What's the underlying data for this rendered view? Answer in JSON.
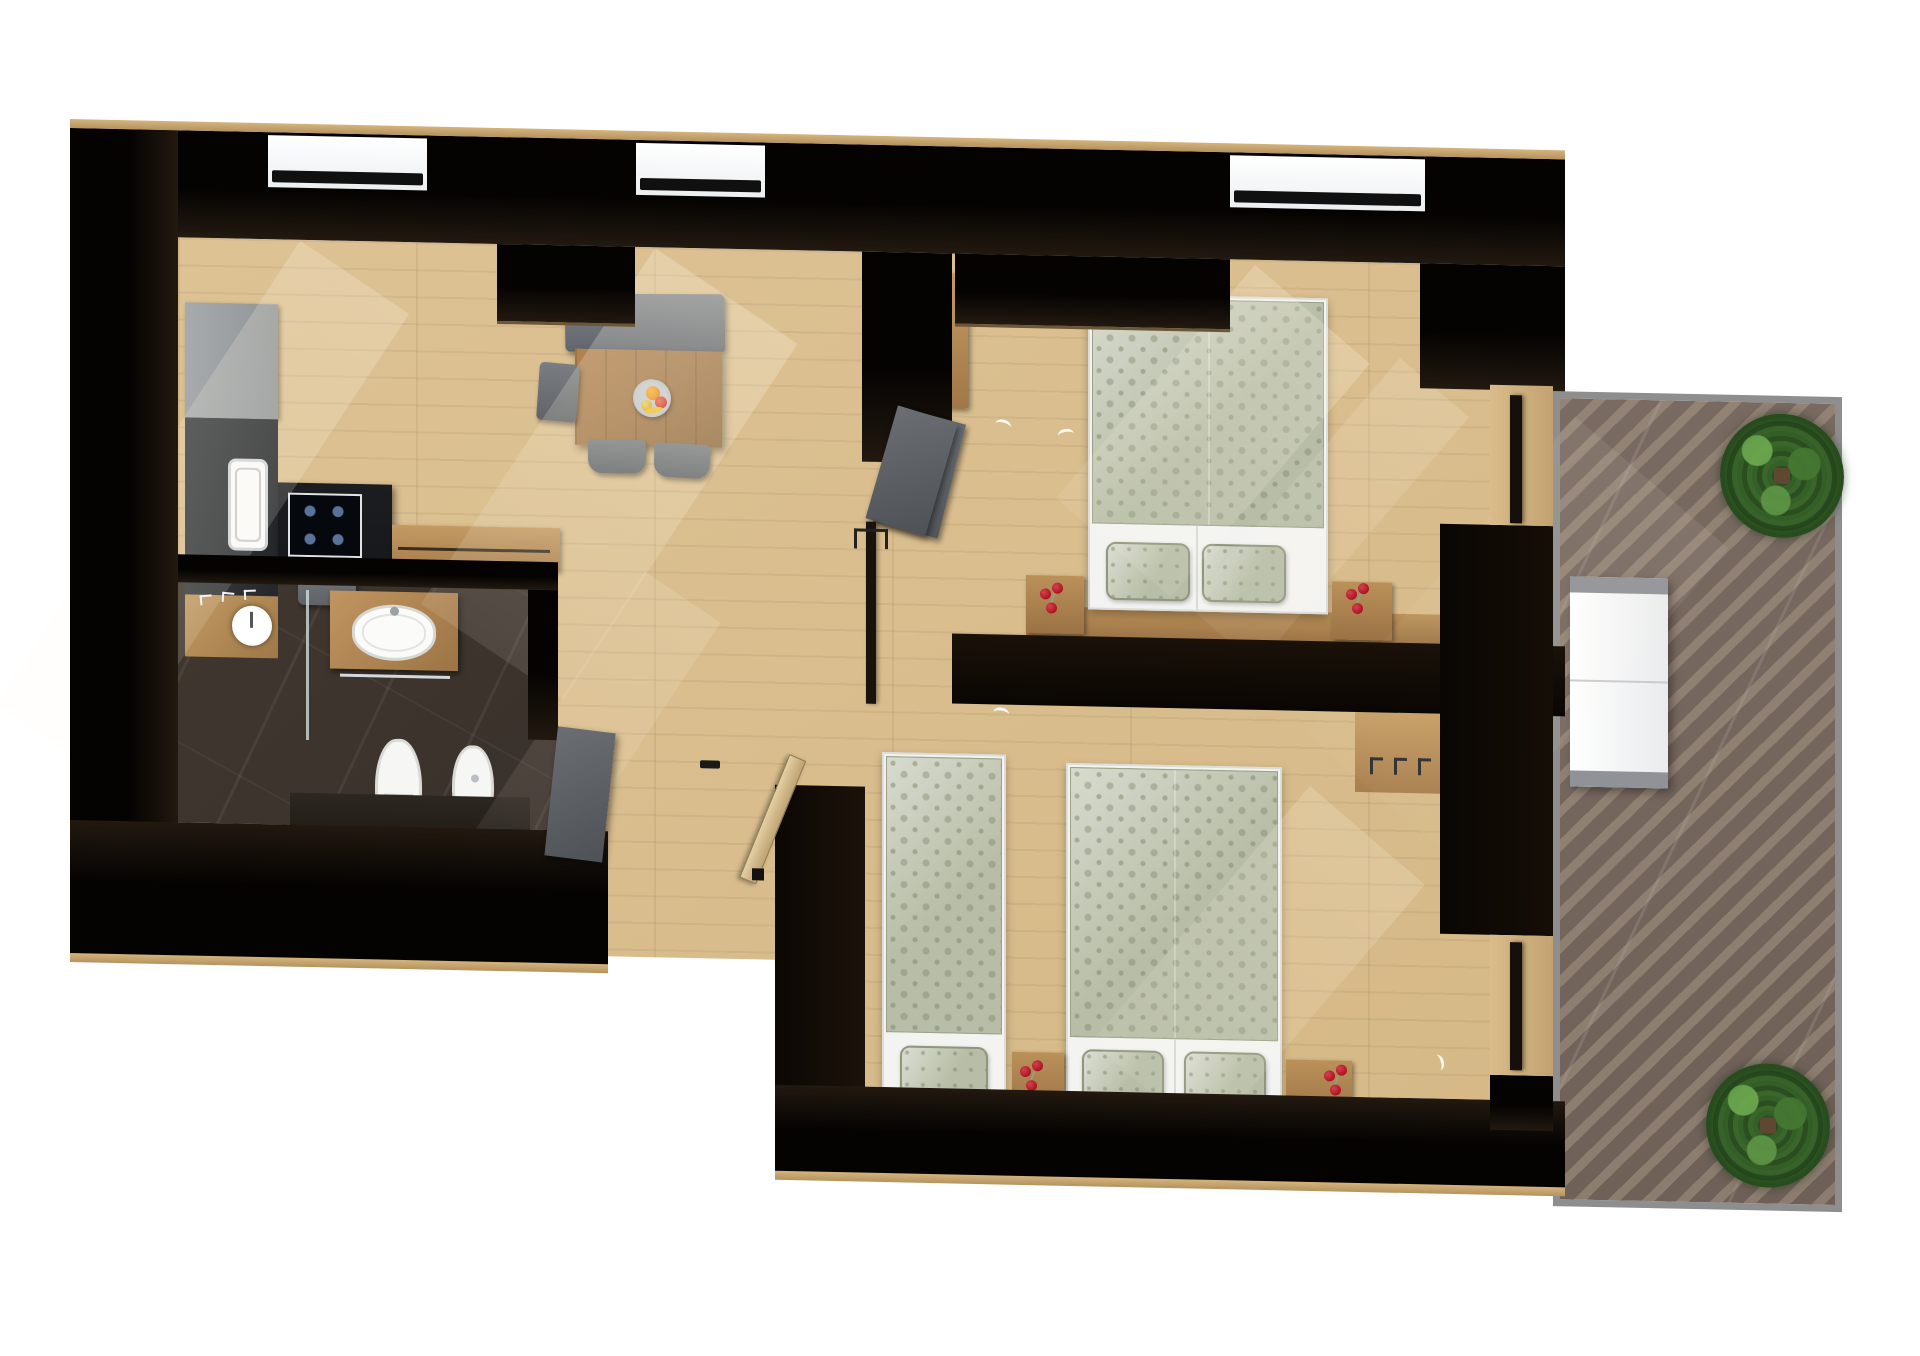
{
  "title": "Top-down 3D rendered apartment floor plan",
  "notes": "Photorealistic bird's-eye render; the image contains no visible text, labels or numbers.",
  "palette": {
    "wall": "#0a0705",
    "wallFace": "#221910",
    "woodFloor": "#ddc294",
    "woodFurniture": "#ae8454",
    "sage": "#b7bda6",
    "sageDark": "#8f967c",
    "white": "#f3f3f1",
    "grayFurniture": "#6f7276",
    "darkCounter": "#16181b",
    "marble": "#39312b",
    "terraceFloor": "#6e6057",
    "terraceStripe": "#c4b29c",
    "rail": "#8e8e8e",
    "plant": "#2f5526",
    "rose": "#a81522",
    "sill": "#f7f7f7"
  },
  "rooms": [
    {
      "name": "living-dining-kitchen",
      "furniture": [
        "kitchen counter with sink",
        "induction cooktop island",
        "counter stool",
        "wood sideboard",
        "dining table",
        "fruit bowl",
        "gray bench",
        "three gray chairs"
      ],
      "windows": 2
    },
    {
      "name": "bathroom",
      "furniture": [
        "walk-in shower with rain head and glass screen",
        "wood vanity with oval basin",
        "wall-hung toilet",
        "bidet",
        "towel hooks"
      ],
      "floor": "dark marble tile"
    },
    {
      "name": "bedroom-1",
      "furniture": [
        "double bed with sage patterned duvet and two pillows",
        "two wood nightstands",
        "red roses in vases",
        "wardrobe with open gray door",
        "built-in black wardrobe",
        "terrace door"
      ],
      "windows": 1
    },
    {
      "name": "bedroom-2",
      "furniture": [
        "single bed with sage duvet and one pillow",
        "double bed with sage duvet and two pillows",
        "two wood nightstands",
        "red roses in vases",
        "wood closet niche",
        "coat hooks",
        "terrace door"
      ]
    },
    {
      "name": "hallway-entry",
      "furniture": [
        "entrance door standing open",
        "bathroom door standing open",
        "bedroom doors standing open"
      ]
    },
    {
      "name": "terrace",
      "furniture": [
        "white two-seat bench",
        "two potted shrubs"
      ],
      "floor": "dark tile with diagonal sun stripes",
      "border": "gray railing"
    }
  ]
}
